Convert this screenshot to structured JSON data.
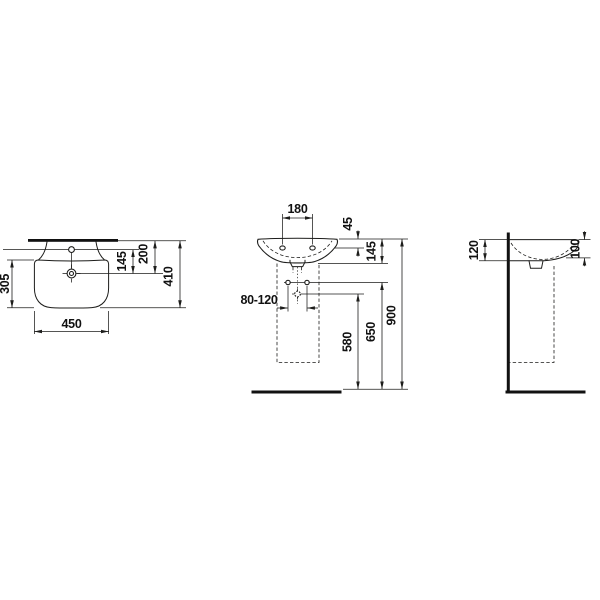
{
  "drawing": {
    "type": "washbasin-technical-drawing",
    "background_color": "#ffffff",
    "line_color": "#1d1d1b",
    "views": {
      "top": {
        "dimensions": {
          "basin_width": "450",
          "total_depth": "410",
          "bowl_depth": "305",
          "taphole_to_drain": "145",
          "wall_to_drain": "200"
        }
      },
      "front": {
        "dimensions": {
          "fixing_hole_spacing": "180",
          "rim_to_fixing_holes": "45",
          "ceramic_height": "145",
          "supply_spacing": "80-120",
          "drain_height": "580",
          "supply_height": "650",
          "rim_height": "900"
        }
      },
      "side": {
        "dimensions": {
          "rear_edge_height": "120",
          "front_edge_height": "100"
        }
      }
    }
  }
}
